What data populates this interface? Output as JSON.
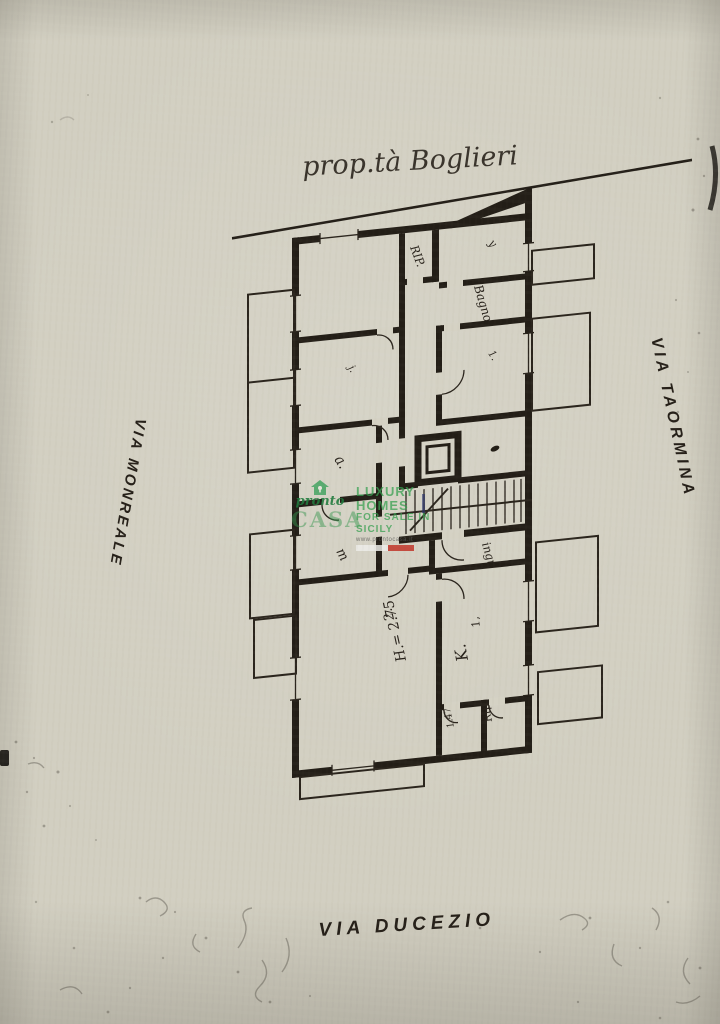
{
  "page": {
    "paper_color": "#d2cfc1",
    "ink_color": "#231e17"
  },
  "annotations": {
    "property_title": "prop.tà Boglieri",
    "street_right": "VIA TAORMINA",
    "street_left": "VIA MONREALE",
    "street_bottom": "VIA DUCEZIO"
  },
  "watermark": {
    "logo_top": "pronto",
    "logo_main": "CASA",
    "tagline1": "LUXURY HOMES",
    "tagline2": "FOR SALE IN SICILY",
    "website": "www.prontocasa.it",
    "green": "#2f9e54",
    "flag_red": "#c23a2e"
  },
  "floorplan": {
    "labels": {
      "closet_top": "RIP.",
      "bathroom": "Bagno",
      "hall": "ingr.",
      "room_a": "a.",
      "room_m": "m",
      "living_number": "2.",
      "height_note": "H.= 2.75",
      "kitchen_number": "1,",
      "kitchen": "K.",
      "closet_size": "1.47",
      "closet_bottom": "Rip",
      "mark_topright": "y",
      "mark_midright": "1.",
      "mark_leftmid": "j."
    }
  }
}
